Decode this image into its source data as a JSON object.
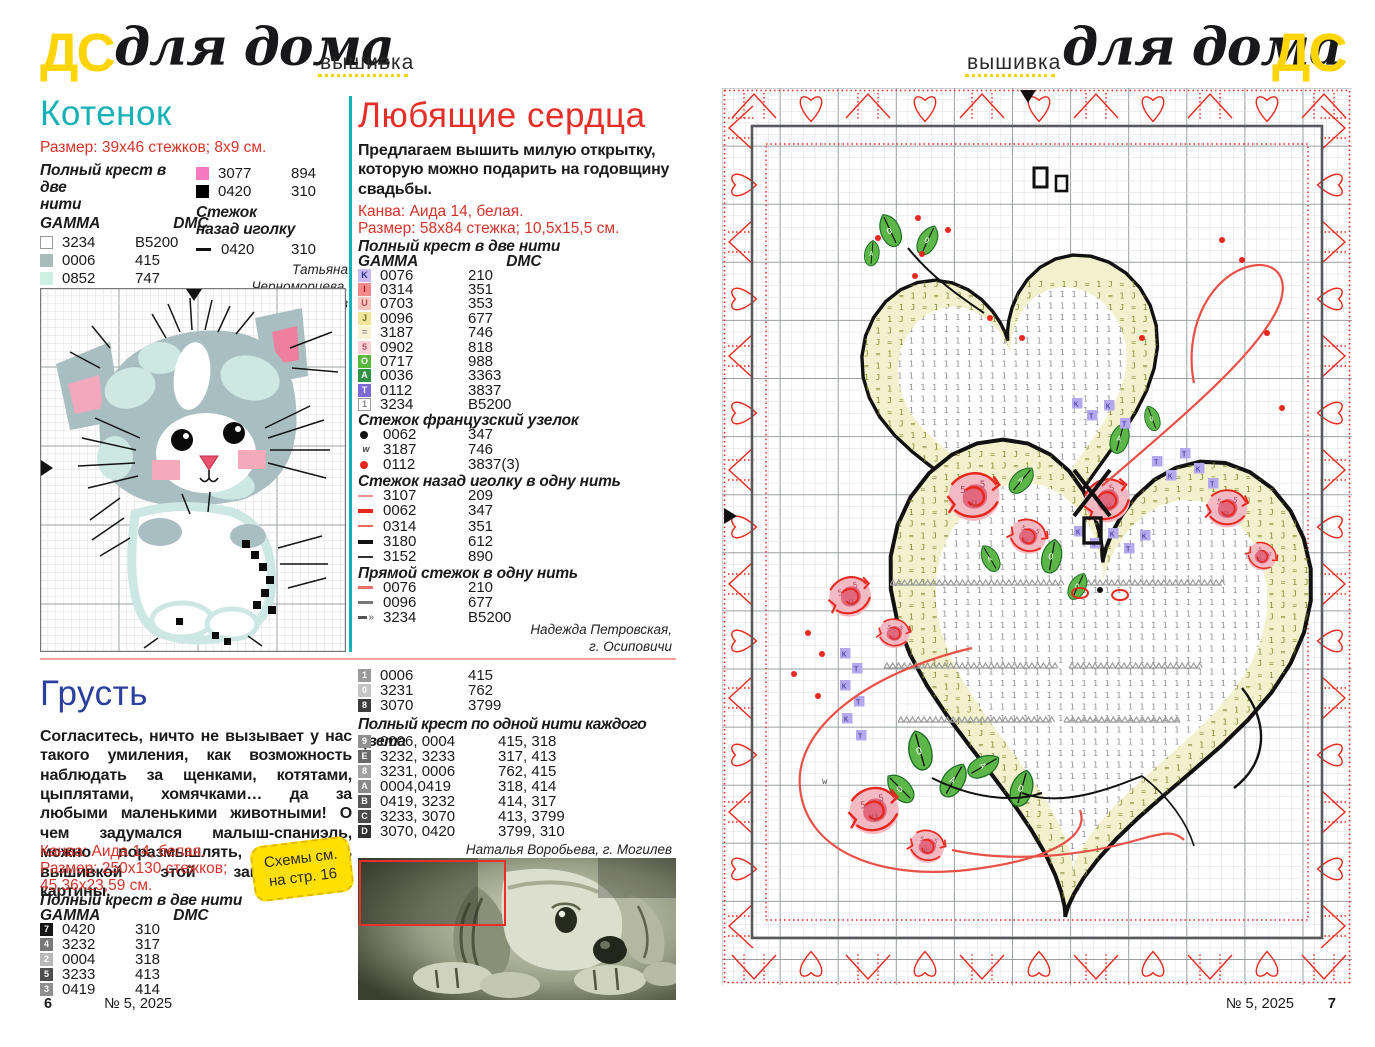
{
  "header_left": {
    "logo": "ДС",
    "brand": "для дома",
    "section": "вышивка"
  },
  "header_right": {
    "logo": "ДС",
    "brand": "для дома",
    "section": "вышивка"
  },
  "kotenok": {
    "title": "Котенок",
    "size_line": "Размер: 39х46 стежков; 8х9 см.",
    "full_cross_header1": "Полный крест в две",
    "full_cross_header2": "нити",
    "col_gamma": "GAMMA",
    "col_dmc": "DMC",
    "full_cross_rows": [
      {
        "sw": "#ffffff",
        "border": true,
        "gamma": "3234",
        "dmc": "B5200"
      },
      {
        "sw": "#a8bcba",
        "gamma": "0006",
        "dmc": "415"
      },
      {
        "sw": "#ccf0e2",
        "gamma": "0852",
        "dmc": "747"
      },
      {
        "sw": "#e83a6a",
        "gamma": "0118",
        "dmc": "891"
      }
    ],
    "full_cross_rows_b": [
      {
        "sw": "#f678c0",
        "gamma": "3077",
        "dmc": "894"
      },
      {
        "sw": "#000000",
        "gamma": "0420",
        "dmc": "310"
      }
    ],
    "backstitch_header1": "Стежок",
    "backstitch_header2": "назад иголку",
    "backstitch_rows": [
      {
        "type": "dash",
        "color": "#111111",
        "h": 3,
        "gamma": "0420",
        "dmc": "310"
      }
    ],
    "credit1": "Татьяна Черноморцева,",
    "credit2": "г. Могилев"
  },
  "grust": {
    "title": "Грусть",
    "body": "Согласитесь, ничто не вызывает у нас такого умиления, как возможность наблюдать за щенками, котятами, цыплятами, хомячками… да за любыми маленькими животными! О чем задумался малыш-спаниэль, можно поразмышлять, занимаясь вышивкой этой замечательной картины.",
    "canvas_line": "Канва: Аида 14, белая.",
    "size_line1": "Размер: 250х130 стежков;",
    "size_line2": "45,36х23,59 см.",
    "badge_line1": "Схемы см.",
    "badge_line2": "на стр. 16",
    "full_cross_header": "Полный крест в две нити",
    "col_gamma": "GAMMA",
    "col_dmc": "DMC",
    "rows": [
      {
        "sym": "7",
        "bg": "#141414",
        "fg": "#ffffff",
        "gamma": "0420",
        "dmc": "310"
      },
      {
        "sym": "4",
        "bg": "#787878",
        "fg": "#ffffff",
        "gamma": "3232",
        "dmc": "317"
      },
      {
        "sym": "2",
        "bg": "#b8b8b8",
        "fg": "#ffffff",
        "gamma": "0004",
        "dmc": "318"
      },
      {
        "sym": "5",
        "bg": "#4f4f4f",
        "fg": "#ffffff",
        "gamma": "3233",
        "dmc": "413"
      },
      {
        "sym": "3",
        "bg": "#8f8f8f",
        "fg": "#ffffff",
        "gamma": "0419",
        "dmc": "414"
      }
    ]
  },
  "serdca": {
    "title": "Любящие сердца",
    "intro": "Предлагаем вышить милую открытку, которую можно подарить на годовщину свадьбы.",
    "canvas_line": "Канва: Аида 14, белая.",
    "size_line": "Размер: 58х84 стежка; 10,5х15,5 см.",
    "full_cross_header": "Полный крест в две нити",
    "col_gamma": "GAMMA",
    "col_dmc": "DMC",
    "full_cross_rows": [
      {
        "sym": "K",
        "bg": "#c9baf0",
        "fg": "#34349a",
        "gamma": "0076",
        "dmc": "210"
      },
      {
        "sym": "I",
        "bg": "#f28a8a",
        "fg": "#a02020",
        "gamma": "0314",
        "dmc": "351"
      },
      {
        "sym": "U",
        "bg": "#f8c6c0",
        "fg": "#b05050",
        "gamma": "0703",
        "dmc": "353"
      },
      {
        "sym": "J",
        "bg": "#efe49a",
        "fg": "#7a7a20",
        "gamma": "0096",
        "dmc": "677"
      },
      {
        "sym": "=",
        "bg": "#f8f3d4",
        "fg": "#888888",
        "gamma": "3187",
        "dmc": "746"
      },
      {
        "sym": "5",
        "bg": "#f8d2d8",
        "fg": "#c05060",
        "gamma": "0902",
        "dmc": "818"
      },
      {
        "sym": "O",
        "bg": "#58b83c",
        "fg": "#ffffff",
        "gamma": "0717",
        "dmc": "988"
      },
      {
        "sym": "A",
        "bg": "#2f9244",
        "fg": "#ffffff",
        "gamma": "0036",
        "dmc": "3363"
      },
      {
        "sym": "T",
        "bg": "#7b6ad8",
        "fg": "#ffffff",
        "gamma": "0112",
        "dmc": "3837"
      },
      {
        "sym": "1",
        "bg": "#ffffff",
        "fg": "#888888",
        "border": true,
        "gamma": "3234",
        "dmc": "B5200"
      }
    ],
    "french_header": "Стежок французский узелок",
    "french_rows": [
      {
        "type": "dot",
        "color": "#111111",
        "gamma": "0062",
        "dmc": "347"
      },
      {
        "type": "char",
        "sym": "w",
        "color": "#444444",
        "gamma": "3187",
        "dmc": "746"
      },
      {
        "type": "dot",
        "color": "#e8281e",
        "gamma": "0112",
        "dmc": "3837(3)"
      }
    ],
    "back_header": "Стежок назад иголку в одну нить",
    "back_rows": [
      {
        "type": "dash",
        "color": "#f09090",
        "h": 2,
        "gamma": "3107",
        "dmc": "209"
      },
      {
        "type": "dash",
        "color": "#e8281e",
        "h": 4,
        "gamma": "0062",
        "dmc": "347"
      },
      {
        "type": "dash",
        "color": "#e86a60",
        "h": 2,
        "gamma": "0314",
        "dmc": "351"
      },
      {
        "type": "dash",
        "color": "#111111",
        "h": 4,
        "gamma": "3180",
        "dmc": "612"
      },
      {
        "type": "dash",
        "color": "#333333",
        "h": 2,
        "gamma": "3152",
        "dmc": "890"
      }
    ],
    "straight_header": "Прямой стежок в одну нить",
    "straight_rows": [
      {
        "type": "dash",
        "color": "#e87068",
        "h": 3,
        "gamma": "0076",
        "dmc": "210"
      },
      {
        "type": "dash",
        "color": "#777777",
        "h": 3,
        "gamma": "0096",
        "dmc": "677"
      },
      {
        "type": "dash",
        "color": "#555555",
        "h": 3,
        "arrows": true,
        "gamma": "3234",
        "dmc": "B5200"
      }
    ],
    "credit1": "Надежда Петровская,",
    "credit2": "г. Осиповичи",
    "grey_rows": [
      {
        "sym": "1",
        "bg": "#9a9a9a",
        "fg": "#ffffff",
        "gamma": "0006",
        "dmc": "415"
      },
      {
        "sym": "0",
        "bg": "#c4c4c4",
        "fg": "#ffffff",
        "gamma": "3231",
        "dmc": "762"
      },
      {
        "sym": "8",
        "bg": "#3c3c3c",
        "fg": "#ffffff",
        "gamma": "3070",
        "dmc": "3799"
      }
    ],
    "blend_header": "Полный крест по одной нити каждого цвета",
    "blend_rows": [
      {
        "sym": "9",
        "bg": "#8f8f8f",
        "fg": "#ffffff",
        "gamma": "0006, 0004",
        "dmc": "415, 318"
      },
      {
        "sym": "E",
        "bg": "#6a6a6a",
        "fg": "#ffffff",
        "gamma": "3232, 3233",
        "dmc": "317, 413"
      },
      {
        "sym": "8",
        "bg": "#a2a2a2",
        "fg": "#ffffff",
        "gamma": "3231, 0006",
        "dmc": "762, 415"
      },
      {
        "sym": "A",
        "bg": "#8a8a8a",
        "fg": "#ffffff",
        "gamma": "0004,0419",
        "dmc": "318, 414"
      },
      {
        "sym": "B",
        "bg": "#555555",
        "fg": "#ffffff",
        "gamma": "0419, 3232",
        "dmc": "414, 317"
      },
      {
        "sym": "C",
        "bg": "#4a4a4a",
        "fg": "#ffffff",
        "gamma": "3233, 3070",
        "dmc": "413, 3799"
      },
      {
        "sym": "D",
        "bg": "#333333",
        "fg": "#ffffff",
        "gamma": "3070, 0420",
        "dmc": "3799, 310"
      }
    ],
    "credit3": "Наталья Воробьева, г. Могилев"
  },
  "footer_left": {
    "page": "6",
    "issue": "№ 5, 2025"
  },
  "footer_right": {
    "issue": "№ 5, 2025",
    "page": "7"
  },
  "chart_symbols": {
    "band": "J=1",
    "inner": "1",
    "rose": "5U5",
    "leaf": "OA",
    "purple": "KT"
  }
}
